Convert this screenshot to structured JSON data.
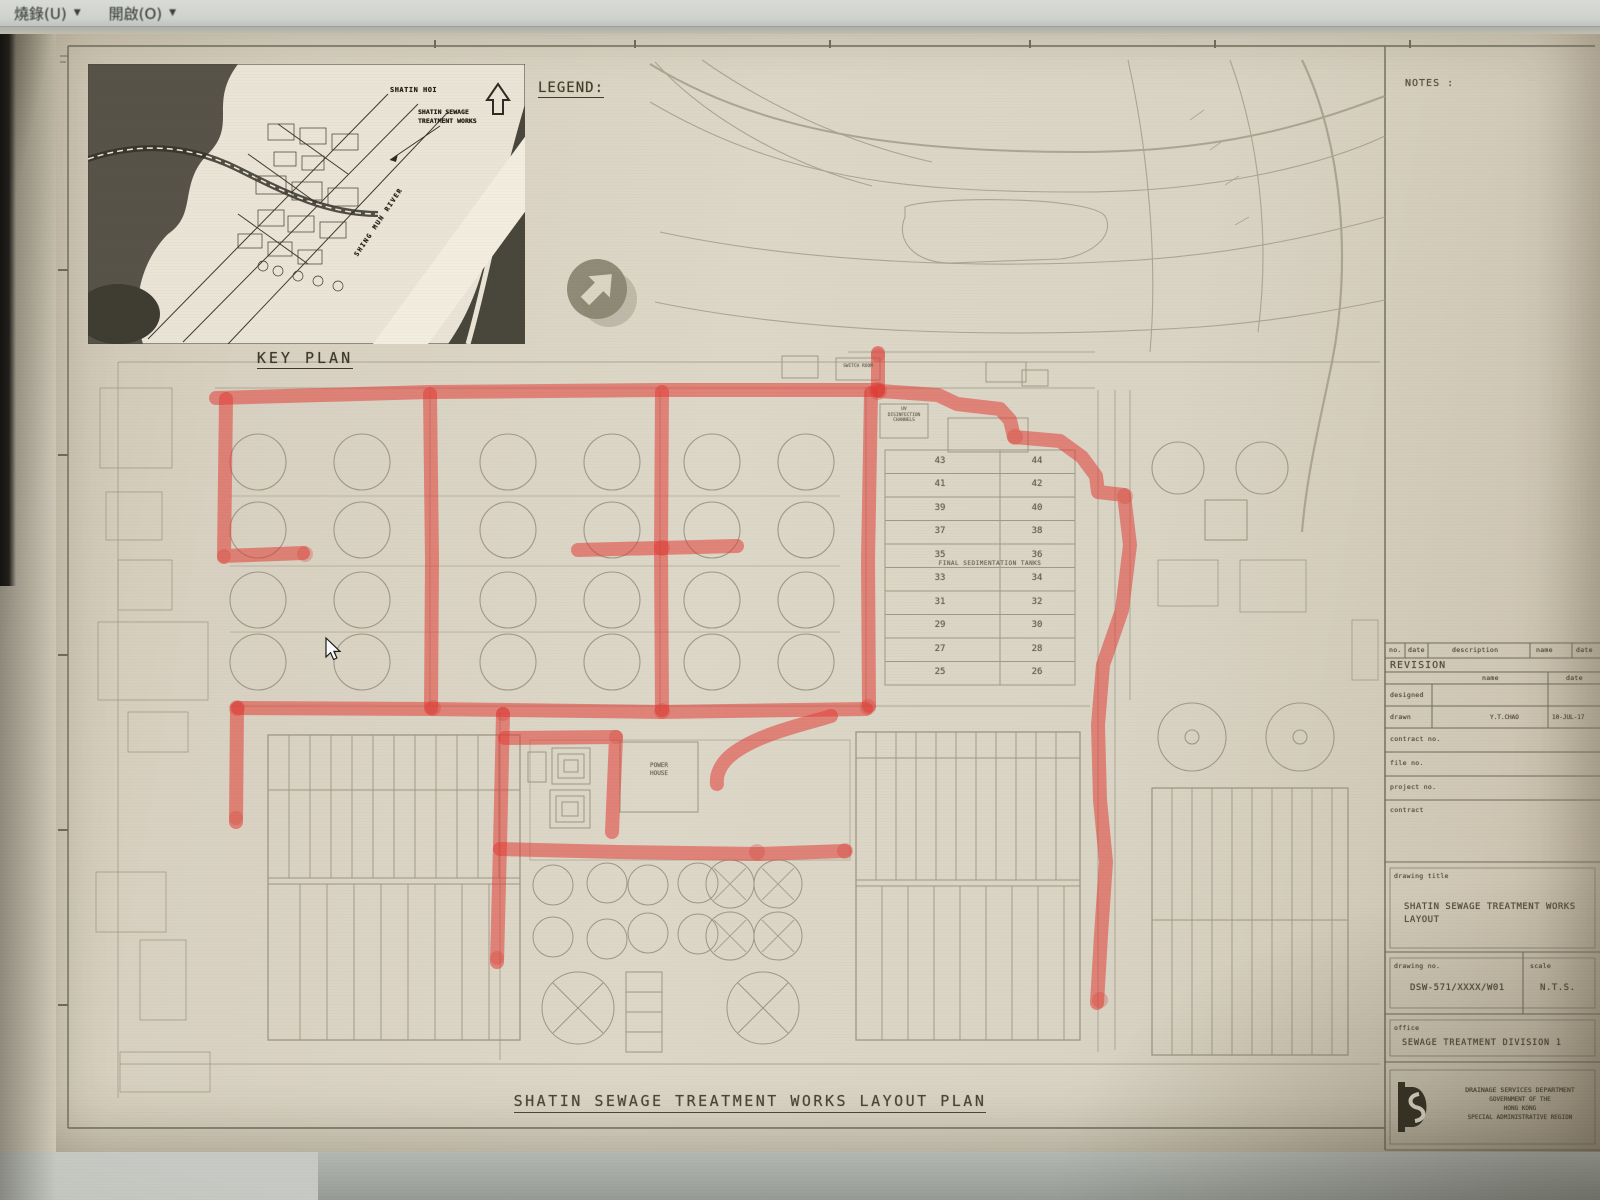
{
  "menubar": {
    "items": [
      {
        "label": "燒錄(U)",
        "arrow": "▼"
      },
      {
        "label": "開啟(O)",
        "arrow": "▼"
      }
    ]
  },
  "sheet": {
    "legend_label": "LEGEND:",
    "notes_label": "NOTES :",
    "main_title": "SHATIN SEWAGE TREATMENT WORKS LAYOUT PLAN",
    "key_plan": {
      "caption": "KEY PLAN",
      "shatin_hoi": "SHATIN HOI",
      "works_label_line1": "SHATIN SEWAGE",
      "works_label_line2": "TREATMENT WORKS",
      "river": "SHING MUN RIVER"
    },
    "plan_labels": {
      "uv_line1": "UV",
      "uv_line2": "DISINFECTION",
      "uv_line3": "CHANNELS",
      "switch_room": "SWITCH ROOM",
      "power_house_line1": "POWER",
      "power_house_line2": "HOUSE",
      "final_sed": "FINAL SEDIMENTATION TANKS"
    },
    "tank_rows": [
      [
        "43",
        "44"
      ],
      [
        "41",
        "42"
      ],
      [
        "39",
        "40"
      ],
      [
        "37",
        "38"
      ],
      [
        "35",
        "36"
      ],
      [
        "33",
        "34"
      ],
      [
        "31",
        "32"
      ],
      [
        "29",
        "30"
      ],
      [
        "27",
        "28"
      ],
      [
        "25",
        "26"
      ]
    ],
    "title_block": {
      "rev_h_no": "no.",
      "rev_h_date": "date",
      "rev_h_desc": "description",
      "rev_h_name": "name",
      "rev_h_date2": "date",
      "revision_label": "REVISION",
      "col_name": "name",
      "col_date": "date",
      "designed_label": "designed",
      "drawn_label": "drawn",
      "drawn_name": "Y.T.CHAO",
      "drawn_date": "10-JUL-17",
      "contract_no_label": "contract  no.",
      "file_no_label": "file  no.",
      "project_no_label": "project  no.",
      "contract_label": "contract",
      "drawing_title_label": "drawing  title",
      "drawing_title_line1": "SHATIN SEWAGE TREATMENT WORKS",
      "drawing_title_line2": "LAYOUT",
      "drawing_no_label": "drawing  no.",
      "drawing_no": "DSW-571/XXXX/W01",
      "scale_label": "scale",
      "scale_value": "N.T.S.",
      "office_label": "office",
      "office_value": "SEWAGE TREATMENT DIVISION 1",
      "department_line1": "DRAINAGE SERVICES DEPARTMENT",
      "department_line2": "GOVERNMENT OF THE",
      "department_line3": "HONG KONG",
      "department_line4": "SPECIAL ADMINISTRATIVE REGION"
    }
  },
  "colors": {
    "marker_red": "#e23e37",
    "paper": "#d8d1c1",
    "line_gray": "#a19a88"
  }
}
